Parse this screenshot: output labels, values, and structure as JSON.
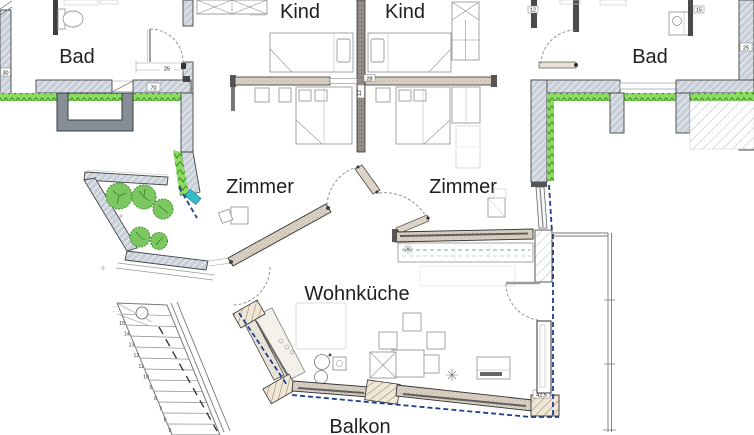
{
  "plan_labels": {
    "bad_left": "Bad",
    "kind_left": "Kind",
    "kind_right": "Kind",
    "bad_right": "Bad",
    "zimmer_left": "Zimmer",
    "zimmer_right": "Zimmer",
    "wohnkueche": "Wohnküche",
    "balkon": "Balkon"
  },
  "dimensions": {
    "left_wall_thickness": "30",
    "left_hall_width": "25",
    "left_door_width": "70",
    "center_wall_a": "28",
    "center_wall_b": "12",
    "right_entry_wall": "12",
    "right_corner_wall": "15",
    "right_wall_thickness": "25",
    "balcony_pier_width": "42,5"
  },
  "stairs": {
    "numbers": [
      "15",
      "14",
      "13",
      "12",
      "11",
      "10",
      "9",
      "8",
      "7",
      "6",
      "5"
    ]
  },
  "kitchen_annotation": "Pos. 40",
  "colors": {
    "insulation_green": "#8ddc62",
    "insulation_zigzag": "#3e8c2a",
    "tree_green": "#7cc761",
    "tree_stroke": "#3f8f2f",
    "wall_hatch_fill": "#c8cfd8",
    "wood_wall": "#d9d0c3",
    "dark_wall": "#4a4a4a",
    "dashed_blue": "#1d3f8f",
    "teal_marker": "#35bdc8",
    "label_color": "#1f1f1f"
  }
}
